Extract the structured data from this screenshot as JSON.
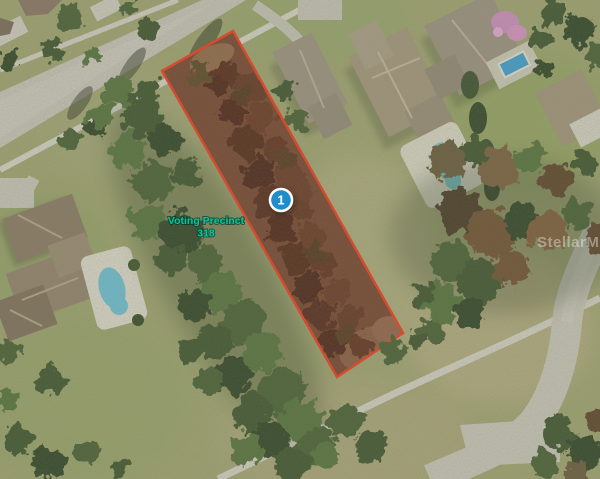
{
  "map": {
    "marker_label": "1",
    "precinct_label": {
      "line1": "Voting Precinct",
      "line2": "318"
    },
    "watermark": "StellarMLS"
  },
  "colors": {
    "parcel_outline": "#f23b21",
    "parcel_fill_tint": "rgba(160,48,30,0.30)",
    "marker_fill": "#1f8dc9",
    "marker_ring": "#ffffff",
    "marker_text": "#ffffff",
    "precinct_label": "#00c9a0",
    "watermark_text": "rgba(255,255,255,0.38)"
  }
}
